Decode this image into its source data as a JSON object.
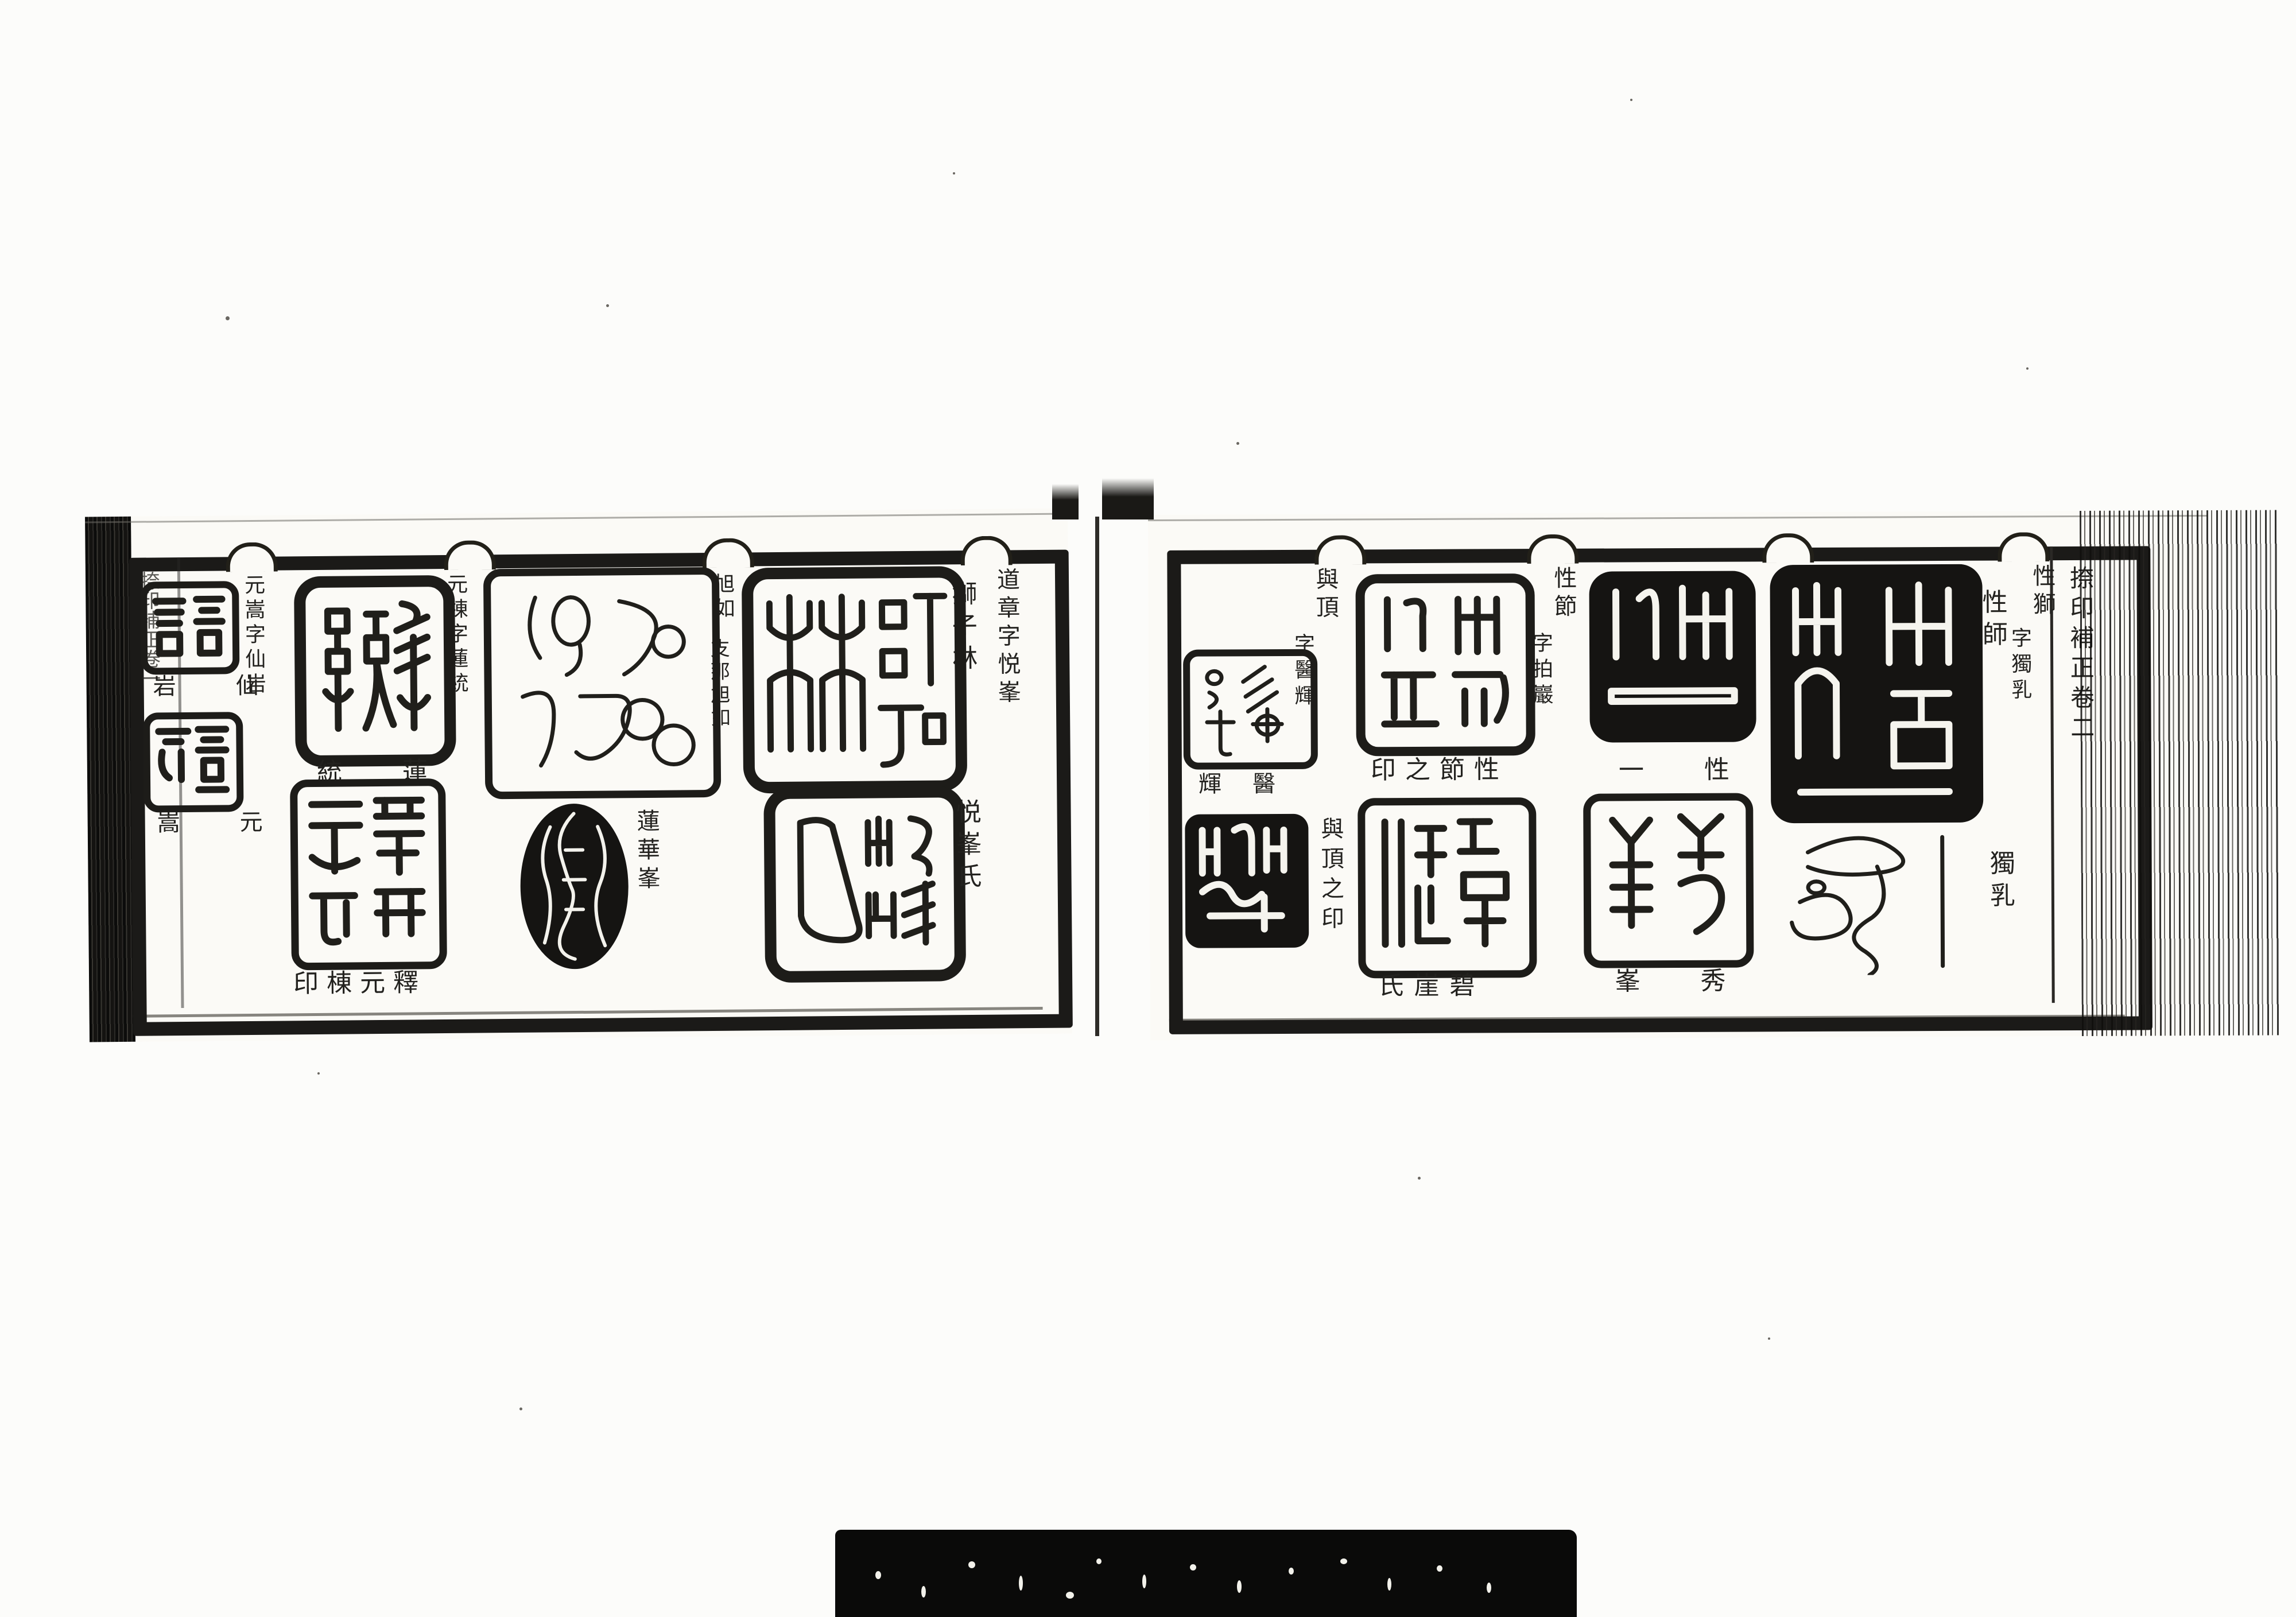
{
  "colors": {
    "paper": "#fbfaf6",
    "ink": "#1d1c1a",
    "backing_bar": "#0a0a09"
  },
  "left_page": {
    "edge_title": "捺印補正卷一",
    "texts": {
      "h_dosho": "道章字悦峯",
      "h_kyokujo_name": "旭如",
      "h_kyokujo_seal": "支那旭如",
      "h_gento": "元棟字蓮統",
      "h_gensho": "元嵩字仙岩",
      "cap_shishirin": "獅子林",
      "cap_eppo": "悦峯氏",
      "cap_renge": "蓮華峯",
      "cap_rento": "統 蓮",
      "cap_shaku": "印棟元釋",
      "cap_sengan": "岩 仙",
      "cap_gensho": "嵩 元"
    },
    "seal_legends": {
      "shishirin": "獅子林",
      "eppo": "悦峯氏",
      "shina": "支那旭如",
      "rento": "蓮統",
      "shaku": "釋元棟印",
      "renge": "蓮華峯",
      "sengan": "仙岩",
      "gensho": "元嵩"
    }
  },
  "right_page": {
    "edge_title": "捺印補正卷二",
    "texts": {
      "h_shoshi_name": "性獅",
      "h_shoshi_style": "字獨乳",
      "h_shosetsu_name": "性節",
      "h_shosetsu_style": "字拍巖",
      "h_yocho_name": "與頂",
      "h_yocho_style": "字醫輝",
      "cap_shoshi": "性師",
      "cap_dokunyu": "獨乳",
      "cap_shosetsu": "印之節性",
      "cap_hekigai": "氏崖碧",
      "cap_shoitsu": "一 性",
      "cap_shuho": "峯 秀",
      "cap_iki": "輝 醫",
      "cap_yocho": "與頂之印"
    },
    "seal_legends": {
      "shoshi": "性師",
      "dokunyu": "獨乳",
      "shosetsu": "性節之印",
      "hekigai": "碧崖氏",
      "shoitsu": "性一",
      "shuho": "秀峯",
      "iki": "醫輝",
      "yocho": "與頂之印"
    }
  }
}
